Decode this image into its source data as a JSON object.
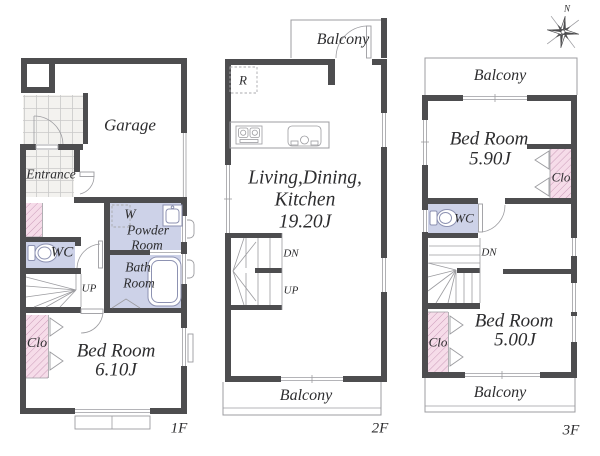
{
  "colors": {
    "wall": "#4d4d4f",
    "water_room_fill": "#cdd2e8",
    "closet_fill": "#f6dce9",
    "closet_hatch": "#c795b4",
    "thin_line": "#9c9ca0",
    "tile_fill": "#f3f2ef",
    "text": "#2d2d2f"
  },
  "floor1": {
    "name": "1F",
    "garage": "Garage",
    "entrance": "Entrance",
    "wc": "WC",
    "powder_l1": "W",
    "powder_l2": "Powder",
    "powder_l3": "Room",
    "bath_l1": "Bath",
    "bath_l2": "Room",
    "up": "UP",
    "clo": "Clo",
    "bed_l1": "Bed Room",
    "bed_l2": "6.10J"
  },
  "floor2": {
    "name": "2F",
    "balcony_top": "Balcony",
    "balcony_bottom": "Balcony",
    "refrigerator": "R",
    "ldk_l1": "Living,Dining,",
    "ldk_l2": "Kitchen",
    "ldk_l3": "19.20J",
    "dn": "DN",
    "up": "UP"
  },
  "floor3": {
    "name": "3F",
    "north": "N",
    "balcony_top": "Balcony",
    "balcony_bottom": "Balcony",
    "bed1_l1": "Bed Room",
    "bed1_l2": "5.90J",
    "clo1": "Clo",
    "wc": "WC",
    "dn": "DN",
    "clo2": "Clo",
    "bed2_l1": "Bed Room",
    "bed2_l2": "5.00J"
  }
}
